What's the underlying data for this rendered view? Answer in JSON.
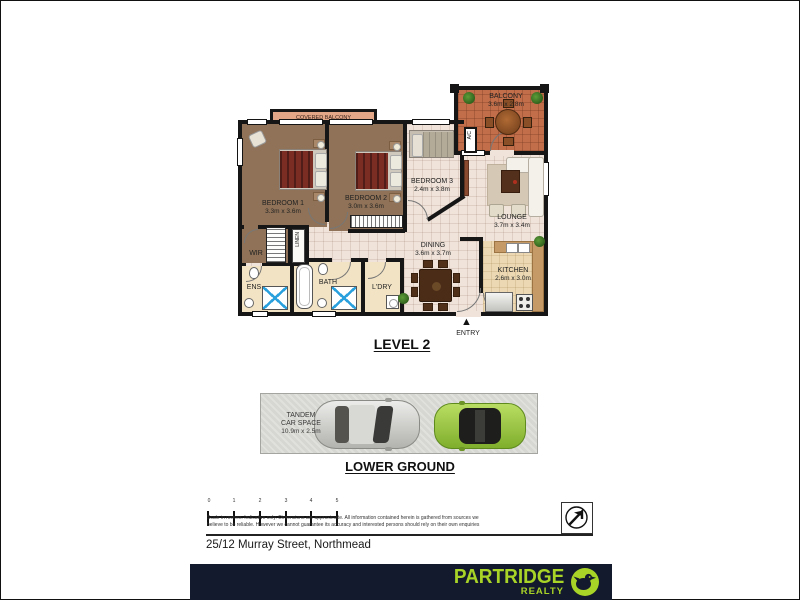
{
  "canvas": {
    "width": 800,
    "height": 600
  },
  "colors": {
    "wall": "#161616",
    "carpet": "#8f7257",
    "tile": "#efe3da",
    "terracotta": "#c26e4a",
    "covered_balcony": "#e3a687",
    "cream": "#f2e3c4",
    "kitchen_floor": "#ecd9b3",
    "parking_grey": "#d6d6d2",
    "shower_blue": "#2aa0dc",
    "brand_navy": "#131a2e",
    "brand_lime": "#a8d327",
    "car_silver": "#c9c9c5",
    "car_green": "#96c63e"
  },
  "level2": {
    "heading": "LEVEL 2",
    "entry_label": "ENTRY",
    "covered_balcony_label": "COVERED BALCONY",
    "ac_label": "A/C",
    "rooms": {
      "balcony": {
        "name": "BALCONY",
        "dims": "3.6m x 2.8m"
      },
      "bedroom1": {
        "name": "BEDROOM 1",
        "dims": "3.3m x 3.6m"
      },
      "bedroom2": {
        "name": "BEDROOM 2",
        "dims": "3.0m x 3.6m"
      },
      "bedroom3": {
        "name": "BEDROOM 3",
        "dims": "2.4m x 3.8m"
      },
      "lounge": {
        "name": "LOUNGE",
        "dims": "3.7m x 3.4m"
      },
      "dining": {
        "name": "DINING",
        "dims": "3.6m x 3.7m"
      },
      "kitchen": {
        "name": "KITCHEN",
        "dims": "2.6m x 3.0m"
      },
      "wir": {
        "name": "WIR"
      },
      "linen": {
        "name": "LINEN"
      },
      "ens": {
        "name": "ENS"
      },
      "bath": {
        "name": "BATH"
      },
      "ldry": {
        "name": "L'DRY"
      }
    }
  },
  "lower_ground": {
    "heading": "LOWER GROUND",
    "car_space": {
      "line1": "TANDEM",
      "line2": "CAR SPACE",
      "line3": "10.9m x 2.5m"
    }
  },
  "footer": {
    "scale_numbers": [
      "0",
      "1",
      "2",
      "3",
      "4",
      "5"
    ],
    "disclaimer1": "Scale in metres. Indicative only. Dimensions are approximate. All information contained herein is gathered from sources we",
    "disclaimer2": "believe to be reliable. However we cannot guarantee its accuracy and interested persons should rely on their own enquiries",
    "address": "25/12 Murray Street, Northmead"
  },
  "brand": {
    "name": "PARTRIDGE",
    "sub": "REALTY"
  },
  "icons": {
    "entry_arrow": "▲",
    "north_arrow": "north-arrow",
    "partridge_bird": "bird"
  }
}
